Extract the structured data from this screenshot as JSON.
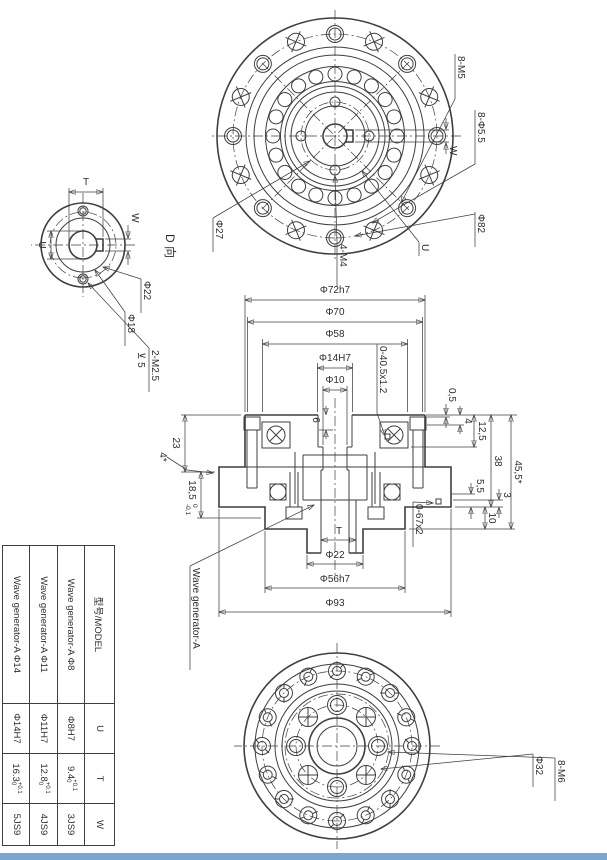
{
  "page": {
    "background": "#ffffff",
    "line_color": "#3f3f3f",
    "bottom_bar_color": "#7ba6cf"
  },
  "front": {
    "m5": "8-M5",
    "d55": "8-Φ5.5",
    "w": "W",
    "d82": "Φ82",
    "u": "U",
    "m4": "4-M4",
    "d27": "Φ27"
  },
  "dview": {
    "title": "D 向",
    "t": "T",
    "w": "W",
    "u": "U",
    "d22": "Φ22",
    "d18": "Φ18",
    "m25": "2-M2.5",
    "depth": "⊻ 5"
  },
  "section": {
    "wg": "Wave generator-A",
    "o1": "0-40.5x1.2",
    "o2": "0-67x2",
    "d72": "Φ72h7",
    "d70": "Φ70",
    "d58": "Φ58",
    "d14": "Φ14H7",
    "d10": "Φ10",
    "d93": "Φ93",
    "d56": "Φ56h7",
    "d22": "Φ22",
    "t": "T",
    "l05": "0,5",
    "l4": "4",
    "l125": "12,5",
    "l38": "38",
    "l455": "45,5*",
    "l55": "5,5",
    "l10": "10",
    "l3": "3",
    "l23": "23",
    "l185": "18,5",
    "l185u": "0",
    "l185d": "-0,1",
    "ch": "4*",
    "l6": "6"
  },
  "back": {
    "m6": "8-M6",
    "d32": "Φ32"
  },
  "table": {
    "header": {
      "model": "型号/MODEL",
      "u": "U",
      "t": "T",
      "w": "W"
    },
    "rows": [
      {
        "model": "Wave generator-A Φ8",
        "u": "Φ8H7",
        "t": "9.4",
        "t_up": "+0.1",
        "t_dn": "0",
        "w": "3JS9"
      },
      {
        "model": "Wave generator-A Φ11",
        "u": "Φ11H7",
        "t": "12.8",
        "t_up": "+0.1",
        "t_dn": "0",
        "w": "4JS9"
      },
      {
        "model": "Wave generator-A Φ14",
        "u": "Φ14H7",
        "t": "16.3",
        "t_up": "+0.1",
        "t_dn": "0",
        "w": "5JS9"
      }
    ]
  }
}
